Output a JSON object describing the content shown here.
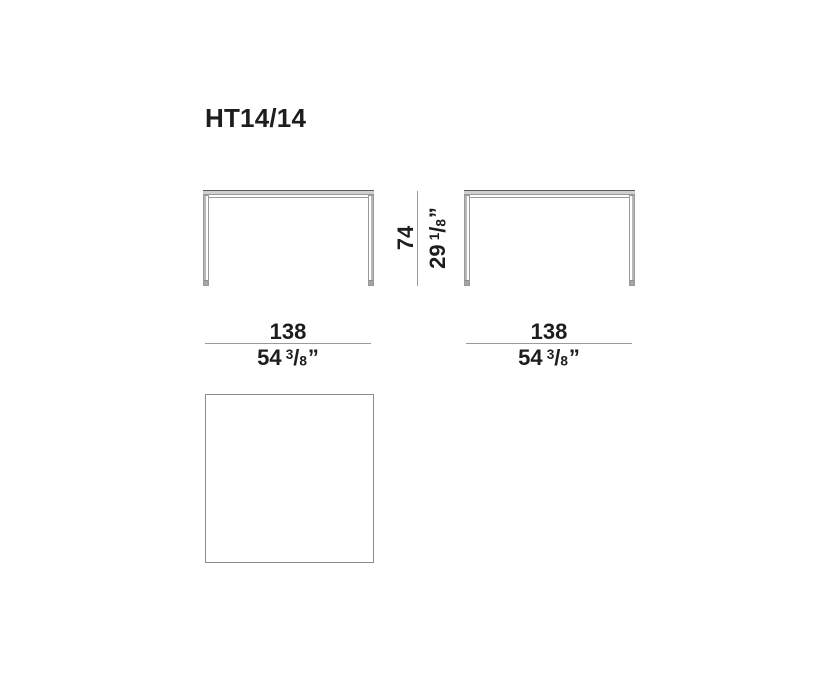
{
  "title": "HT14/14",
  "dimensions": {
    "height": {
      "metric": "74",
      "imperial": {
        "whole": "29",
        "num": "1",
        "slash": "/",
        "den": "8",
        "unit": "”"
      }
    },
    "width_front": {
      "metric": "138",
      "imperial": {
        "whole": "54",
        "num": "3",
        "slash": "/",
        "den": "8",
        "unit": "”"
      }
    },
    "width_side": {
      "metric": "138",
      "imperial": {
        "whole": "54",
        "num": "3",
        "slash": "/",
        "den": "8",
        "unit": "”"
      }
    }
  },
  "colors": {
    "text": "#1d1d1b",
    "dimension_line": "#9a9a9a",
    "tabletop_fill": "#cfcfcf",
    "tabletop_top_edge": "#5a5a5a",
    "leg_shade": "#b8b8b8",
    "top_view_border": "#8a8a8a",
    "background": "#ffffff"
  }
}
